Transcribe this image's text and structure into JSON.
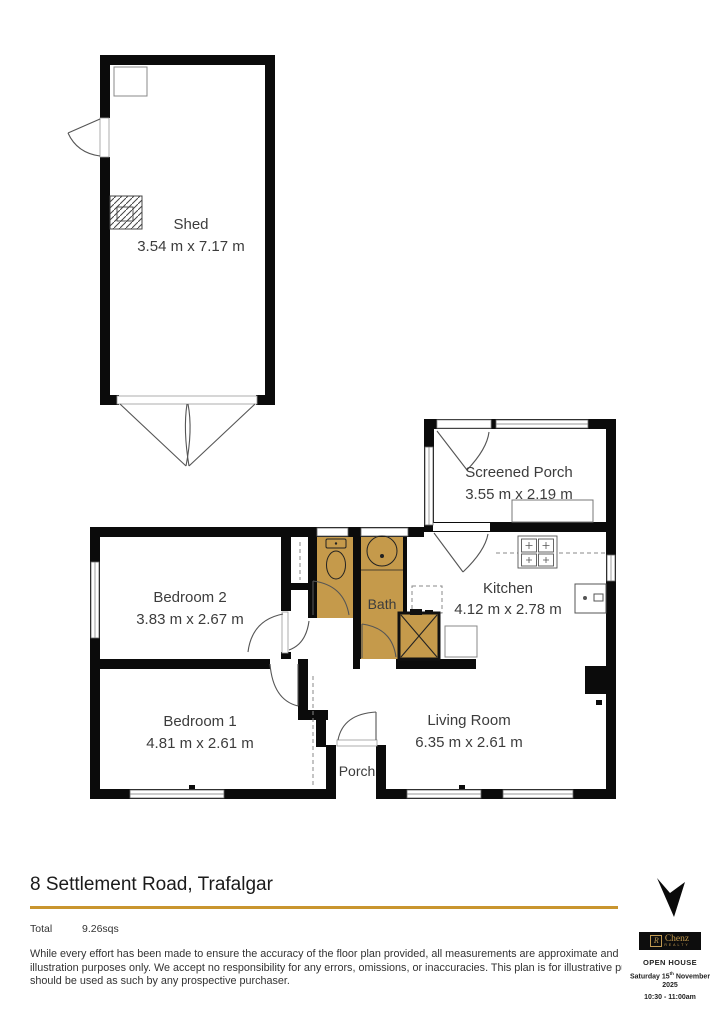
{
  "plan": {
    "shed": {
      "label": "Shed",
      "dims": "3.54 m x 7.17 m"
    },
    "screened_porch": {
      "label": "Screened Porch",
      "dims": "3.55 m x 2.19 m"
    },
    "kitchen": {
      "label": "Kitchen",
      "dims": "4.12 m x 2.78 m"
    },
    "bedroom2": {
      "label": "Bedroom 2",
      "dims": "3.83 m x 2.67 m"
    },
    "bedroom1": {
      "label": "Bedroom 1",
      "dims": "4.81 m x 2.61 m"
    },
    "living_room": {
      "label": "Living Room",
      "dims": "6.35 m x 2.61 m"
    },
    "bath": {
      "label": "Bath"
    },
    "porch": {
      "label": "Porch"
    }
  },
  "footer": {
    "address": "8 Settlement Road, Trafalgar",
    "total_label": "Total",
    "total_value": "9.26sqs",
    "disclaimer_lines": [
      "While every effort has been made to ensure the accuracy of the floor plan provided, all measurements are approximate and inten",
      "illustration purposes only. We accept no responsibility for any errors, omissions, or inaccuracies. This plan is for illustrative purpos",
      "should be used as such by any prospective purchaser."
    ]
  },
  "branding": {
    "agency_name": "Chenz",
    "agency_sub": "REALTY",
    "agency_monogram": "R",
    "open_house_label": "OPEN HOUSE",
    "date_prefix": "Saturday 15",
    "date_sup": "th",
    "date_suffix": " November",
    "year": "2025",
    "time": "10:30 - 11:00am"
  },
  "colors": {
    "wet_area_fill": "#C59A4B",
    "accent_gold": "#C9952F",
    "wall": "#0b0b0b"
  }
}
